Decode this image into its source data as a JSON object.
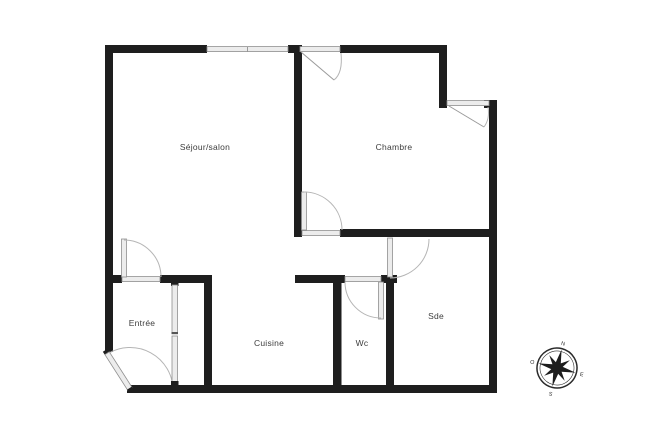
{
  "floorplan": {
    "rooms": {
      "sejour": {
        "label": "Séjour/salon"
      },
      "chambre": {
        "label": "Chambre"
      },
      "entree": {
        "label": "Entrée"
      },
      "cuisine": {
        "label": "Cuisine"
      },
      "wc": {
        "label": "Wc"
      },
      "sde": {
        "label": "Sde"
      }
    },
    "compass": {
      "north": "N",
      "east": "E",
      "south": "S",
      "west": "O"
    },
    "colors": {
      "wall": "#1e1e1e",
      "opening_fill": "#ececec",
      "opening_stroke": "#8f8f8f",
      "swing_arc": "#b5b5b5",
      "label_text": "#3d3d3d"
    }
  }
}
